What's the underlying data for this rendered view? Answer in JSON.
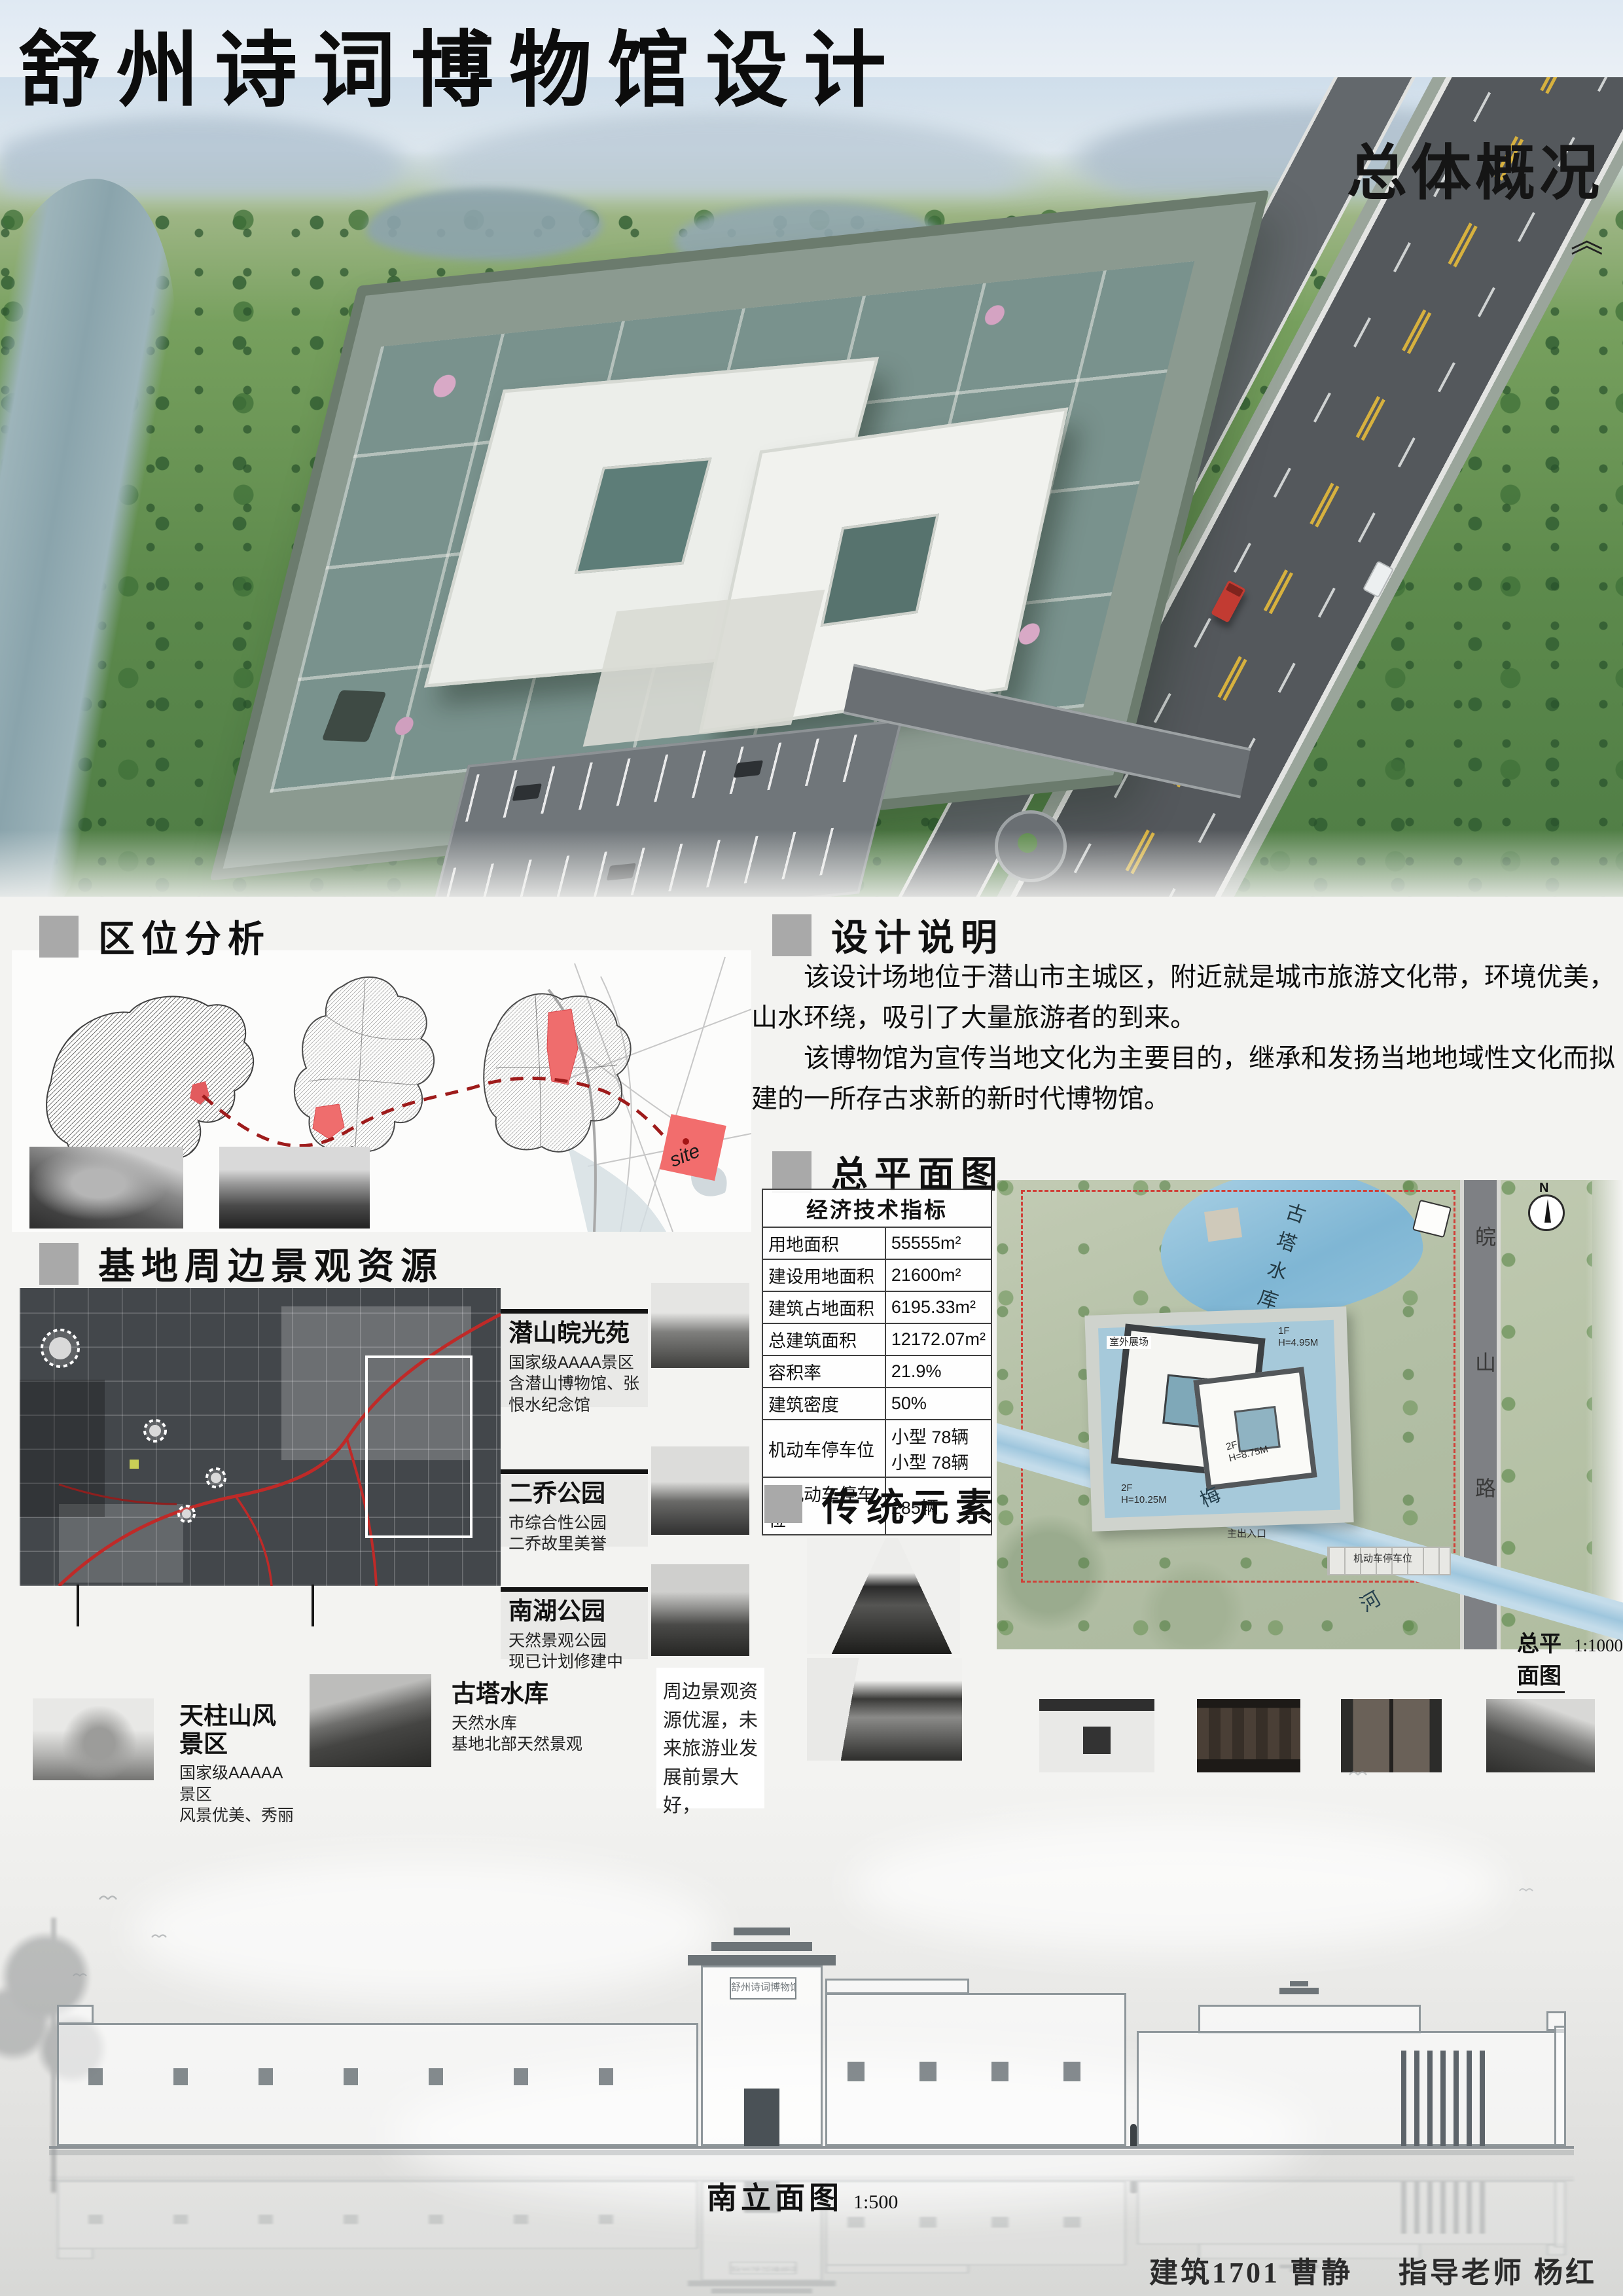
{
  "colors": {
    "accent_red": "#d94a4e",
    "header_square": "#a9a9a9",
    "map_red": "#c5302f"
  },
  "header": {
    "title": "舒州诗词博物馆设计",
    "overview": "总体概况",
    "quote_mark": "《"
  },
  "sections": {
    "location": "区位分析",
    "design_notes": "设计说明",
    "master_plan": "总平面图",
    "resources": "基地周边景观资源",
    "traditional": "传统元素"
  },
  "design_notes": {
    "p1": "该设计场地位于潜山市主城区，附近就是城市旅游文化带，环境优美，山水环绕，吸引了大量旅游者的到来。",
    "p2": "该博物馆为宣传当地文化为主要目的，继承和发扬当地地域性文化而拟建的一所存古求新的新时代博物馆。"
  },
  "indicators": {
    "header": "经济技术指标",
    "rows": [
      {
        "label": "用地面积",
        "value": "55555m²"
      },
      {
        "label": "建设用地面积",
        "value": "21600m²"
      },
      {
        "label": "建筑占地面积",
        "value": "6195.33m²"
      },
      {
        "label": "总建筑面积",
        "value": "12172.07m²"
      },
      {
        "label": "容积率",
        "value": "21.9%"
      },
      {
        "label": "建筑密度",
        "value": "50%"
      },
      {
        "label": "机动车停车位",
        "value": "小型 78辆\n小型 78辆"
      },
      {
        "label": "非机动车停车位",
        "value": "285辆"
      }
    ]
  },
  "site_map": {
    "site_label": "site"
  },
  "resources": {
    "items": [
      {
        "name": "潜山皖光苑",
        "desc": "国家级AAAA景区\n含潜山博物馆、张恨水纪念馆"
      },
      {
        "name": "二乔公园",
        "desc": "市综合性公园\n二乔故里美誉"
      },
      {
        "name": "南湖公园",
        "desc": "天然景观公园\n现已计划修建中"
      },
      {
        "name": "天柱山风景区",
        "desc": "国家级AAAAA景区\n风景优美、秀丽"
      },
      {
        "name": "古塔水库",
        "desc": "天然水库\n基地北部天然景观"
      }
    ],
    "note": "周边景观资源优渥，未来旅游业发展前景大好，"
  },
  "plan": {
    "lake": "古塔水库",
    "road": "皖山路",
    "river_a": "梅",
    "river_b": "河",
    "north": "N",
    "outdoor_area": "室外展场",
    "label_1f": "1F\nH=4.95M",
    "label_2f_a": "2F\nH=8.75M",
    "label_2f_b": "2F\nH=10.25M",
    "main_entrance": "主出入口",
    "parking": "机动车停车位",
    "caption": "总平面图",
    "scale": "1:1000"
  },
  "elevation": {
    "caption": "南立面图",
    "scale": "1:500",
    "sign": "舒州诗词博物馆"
  },
  "footer": {
    "credit": "建筑1701 曹静",
    "advisor": "指导老师 杨红"
  }
}
